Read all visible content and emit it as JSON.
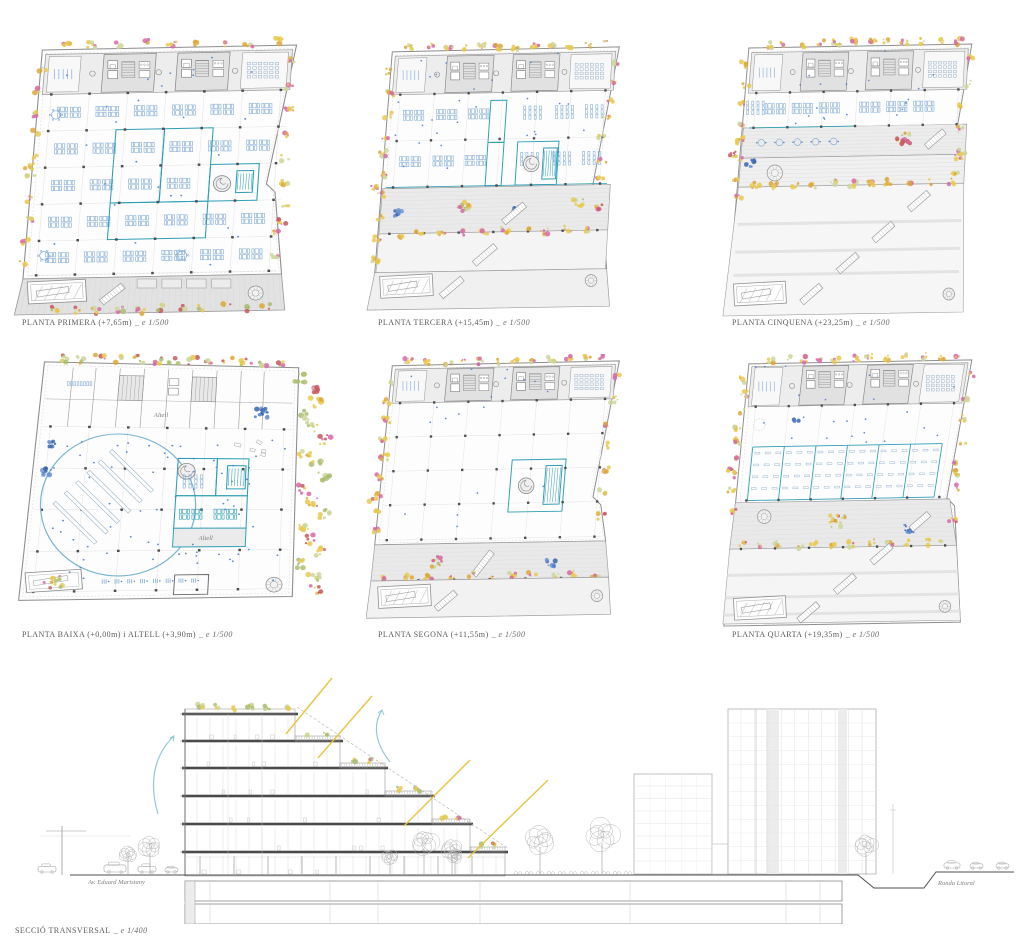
{
  "sheet": {
    "plans": [
      {
        "id": "planta-primera",
        "title": "PLANTA PRIMERA (+7,65m)",
        "scale_note": "_ e 1/500"
      },
      {
        "id": "planta-tercera",
        "title": "PLANTA TERCERA (+15,45m)",
        "scale_note": "_ e 1/500"
      },
      {
        "id": "planta-cinquena",
        "title": "PLANTA CINQUENA (+23,25m)",
        "scale_note": "_ e 1/500"
      },
      {
        "id": "planta-baixa",
        "title": "PLANTA BAIXA (+0,00m) i ALTELL (+3,90m)",
        "scale_note": "_ e 1/500",
        "annotations": [
          "Altell",
          "Altell"
        ]
      },
      {
        "id": "planta-segona",
        "title": "PLANTA SEGONA (+11,55m)",
        "scale_note": "_ e 1/500"
      },
      {
        "id": "planta-quarta",
        "title": "PLANTA QUARTA (+19,35m)",
        "scale_note": "_ e 1/500"
      }
    ],
    "section": {
      "title": "SECCIÓ TRANSVERSAL",
      "scale_note": "_ e 1/400",
      "street_left": "Av. Eduard Maristany",
      "street_right": "Ronda Litoral"
    },
    "colors": {
      "furniture_blue": "#7fa9d2",
      "accent_teal": "#2f9fb6",
      "people_blue": "#4f7ec9",
      "veg_yellow": "#e8c94f",
      "veg_gold": "#dba83c",
      "veg_pink": "#d56aa6",
      "veg_red": "#c4585c",
      "veg_green": "#a9bd72",
      "veg_lightgreen": "#ccd69b",
      "sun_yellow": "#e7c33c",
      "breeze_blue": "#93c6d6"
    }
  }
}
